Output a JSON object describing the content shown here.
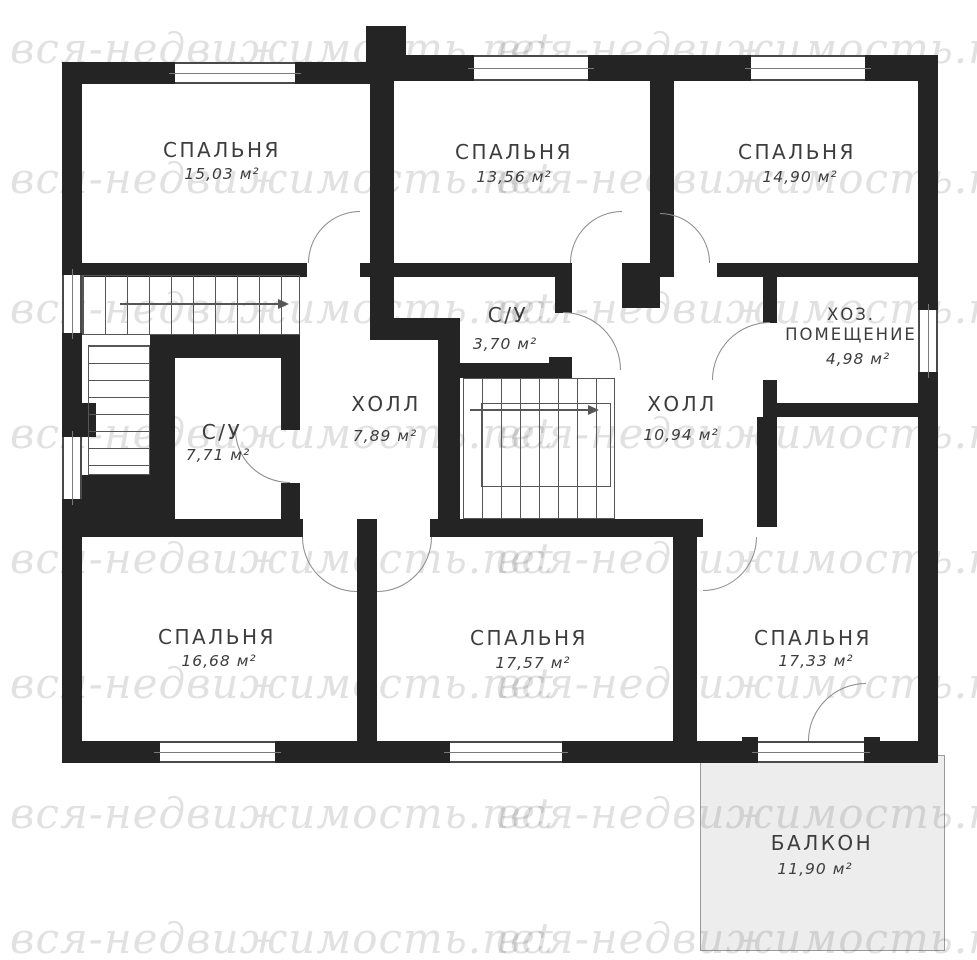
{
  "watermark": {
    "text": "вся-недвижимость.net"
  },
  "rooms": [
    {
      "id": "bedroom-top-left",
      "name": "СПАЛЬНЯ",
      "area": "15,03 м²"
    },
    {
      "id": "bedroom-top-middle",
      "name": "СПАЛЬНЯ",
      "area": "13,56 м²"
    },
    {
      "id": "bedroom-top-right",
      "name": "СПАЛЬНЯ",
      "area": "14,90 м²"
    },
    {
      "id": "utility-room",
      "name_line1": "ХОЗ.",
      "name_line2": "ПОМЕЩЕНИЕ",
      "area": "4,98 м²"
    },
    {
      "id": "bathroom-small",
      "name": "С/У",
      "area": "3,70 м²"
    },
    {
      "id": "bathroom-large",
      "name": "С/У",
      "area": "7,71 м²"
    },
    {
      "id": "hall-west",
      "name": "ХОЛЛ",
      "area": "7,89 м²"
    },
    {
      "id": "hall-east",
      "name": "ХОЛЛ",
      "area": "10,94 м²"
    },
    {
      "id": "bedroom-bottom-left",
      "name": "СПАЛЬНЯ",
      "area": "16,68 м²"
    },
    {
      "id": "bedroom-bottom-middle",
      "name": "СПАЛЬНЯ",
      "area": "17,57 м²"
    },
    {
      "id": "bedroom-bottom-right",
      "name": "СПАЛЬНЯ",
      "area": "17,33 м²"
    },
    {
      "id": "balcony",
      "name": "БАЛКОН",
      "area": "11,90 м²"
    }
  ]
}
